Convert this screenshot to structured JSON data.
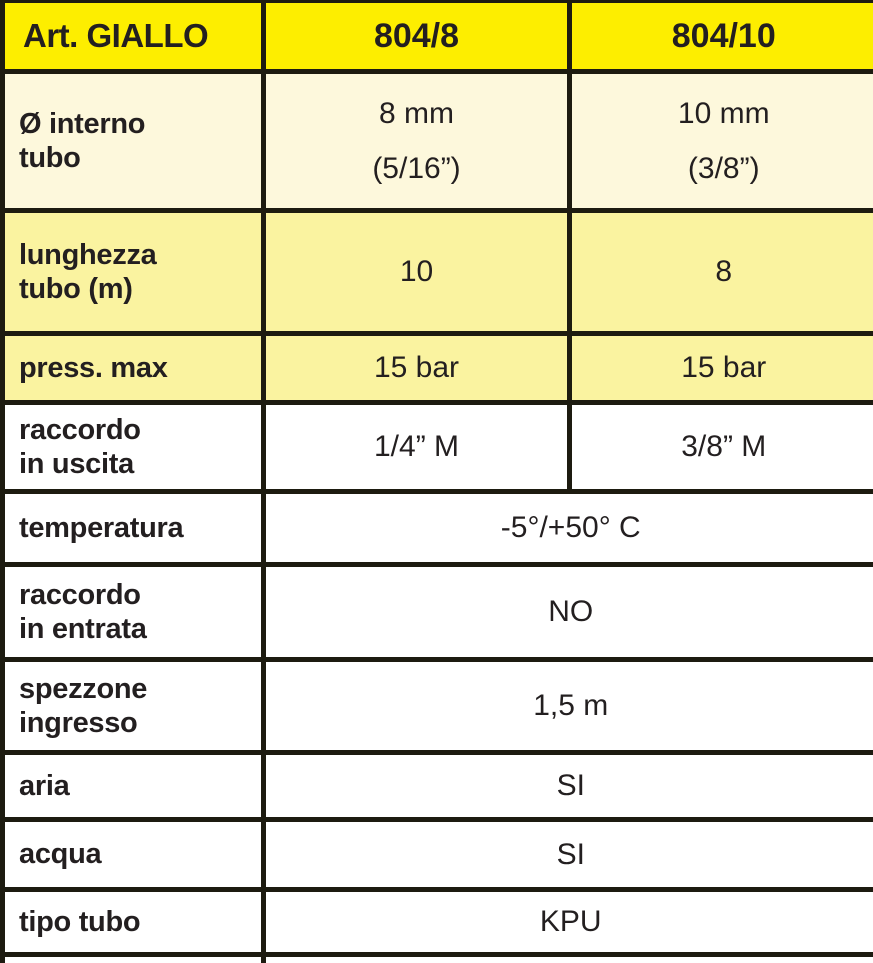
{
  "colors": {
    "header_yellow": "#FDEE00",
    "row_cream": "#FDF8DC",
    "row_light_yellow": "#FAF3A0",
    "line": "#1D1B10",
    "text": "#231F20"
  },
  "table": {
    "header": {
      "title": "Art. GIALLO",
      "columns": [
        "804/8",
        "804/10"
      ]
    },
    "rows": [
      {
        "label": "Ø interno\ntubo",
        "values": [
          "8 mm\n(5/16”)",
          "10 mm\n(3/8”)"
        ]
      },
      {
        "label": "lunghezza\ntubo (m)",
        "values": [
          "10",
          "8"
        ]
      },
      {
        "label": "press. max",
        "values": [
          "15 bar",
          "15 bar"
        ]
      },
      {
        "label": "raccordo\nin uscita",
        "values": [
          "1/4” M",
          "3/8” M"
        ]
      },
      {
        "label": "temperatura",
        "value": "-5°/+50° C"
      },
      {
        "label": "raccordo\nin entrata",
        "value": "NO"
      },
      {
        "label": "spezzone\ningresso",
        "value": "1,5 m"
      },
      {
        "label": "aria",
        "value": "SI"
      },
      {
        "label": "acqua",
        "value": "SI"
      },
      {
        "label": "tipo tubo",
        "value": "KPU"
      }
    ]
  }
}
